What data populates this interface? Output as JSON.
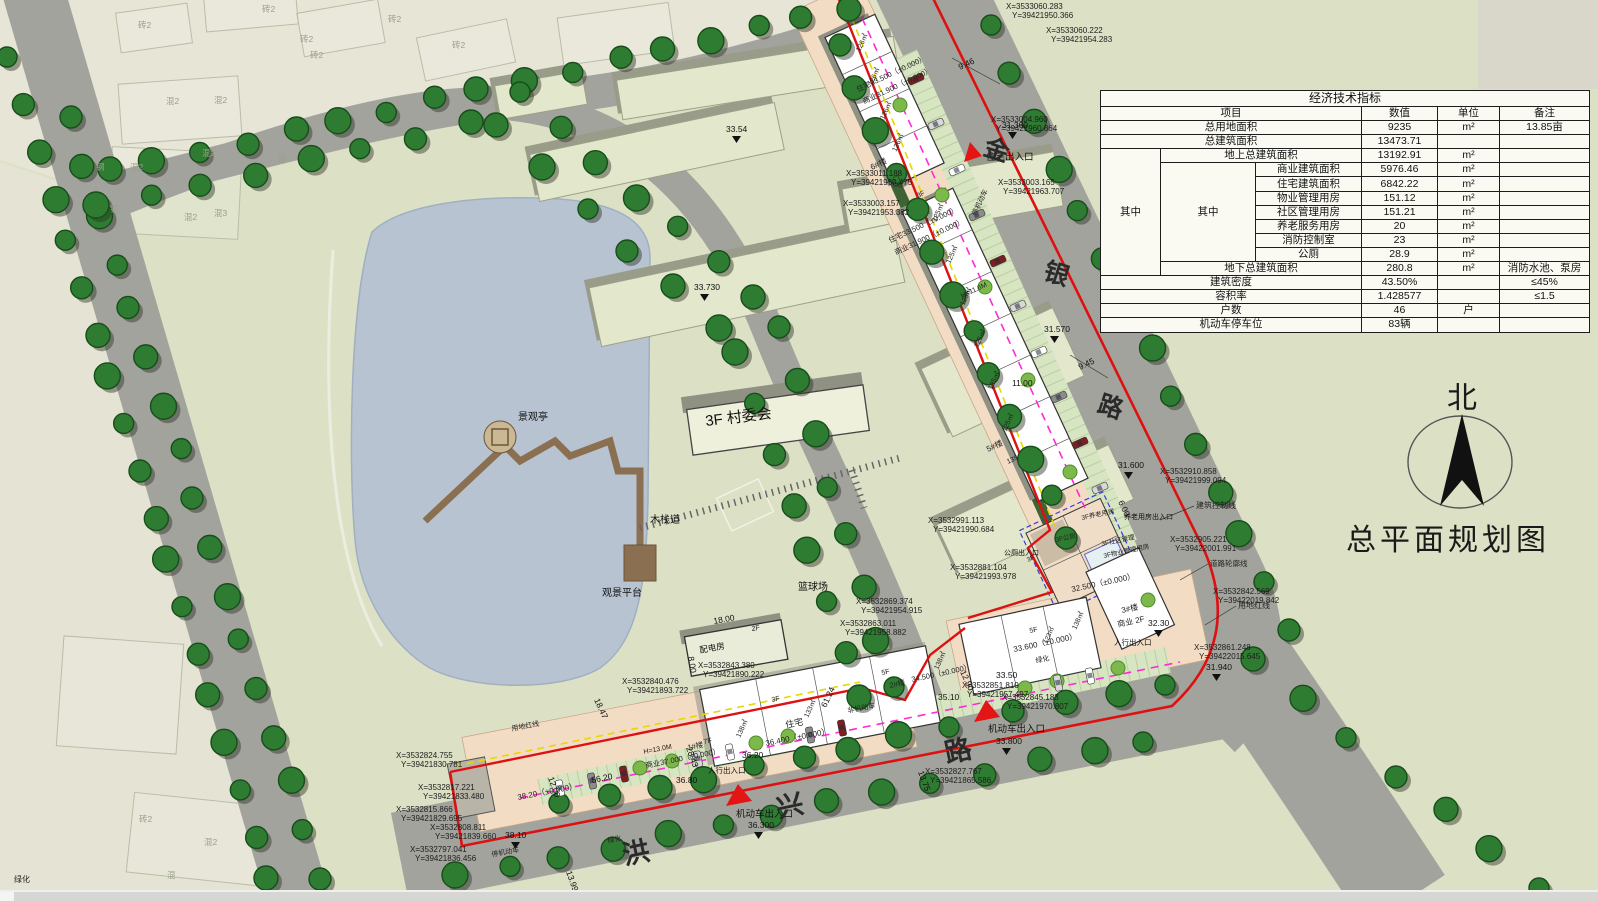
{
  "title": "总平面规划图",
  "north_label": "北",
  "table": {
    "title": "经济技术指标",
    "headers": {
      "item": "项目",
      "value": "数值",
      "unit": "单位",
      "remark": "备注"
    },
    "group_outer": "其中",
    "group_inner": "其中",
    "rows": [
      {
        "item": "总用地面积",
        "value": "9235",
        "unit": "m²",
        "remark": "13.85亩",
        "level": 0
      },
      {
        "item": "总建筑面积",
        "value": "13473.71",
        "unit": "",
        "remark": "",
        "level": 0
      },
      {
        "item": "地上总建筑面积",
        "value": "13192.91",
        "unit": "m²",
        "remark": "",
        "level": 1
      },
      {
        "item": "商业建筑面积",
        "value": "5976.46",
        "unit": "m²",
        "remark": "",
        "level": 2
      },
      {
        "item": "住宅建筑面积",
        "value": "6842.22",
        "unit": "m²",
        "remark": "",
        "level": 2
      },
      {
        "item": "物业管理用房",
        "value": "151.12",
        "unit": "m²",
        "remark": "",
        "level": 2
      },
      {
        "item": "社区管理用房",
        "value": "151.21",
        "unit": "m²",
        "remark": "",
        "level": 2
      },
      {
        "item": "养老服务用房",
        "value": "20",
        "unit": "m²",
        "remark": "",
        "level": 2
      },
      {
        "item": "消防控制室",
        "value": "23",
        "unit": "m²",
        "remark": "",
        "level": 2
      },
      {
        "item": "公厕",
        "value": "28.9",
        "unit": "m²",
        "remark": "",
        "level": 2
      },
      {
        "item": "地下总建筑面积",
        "value": "280.8",
        "unit": "m²",
        "remark": "消防水池、泵房",
        "level": 1
      },
      {
        "item": "建筑密度",
        "value": "43.50%",
        "unit": "",
        "remark": "≤45%",
        "level": 0
      },
      {
        "item": "容积率",
        "value": "1.428577",
        "unit": "",
        "remark": "≤1.5",
        "level": 0
      },
      {
        "item": "户数",
        "value": "46",
        "unit": "户",
        "remark": "",
        "level": 0
      },
      {
        "item": "机动车停车位",
        "value": "83辆",
        "unit": "",
        "remark": "",
        "level": 0
      }
    ]
  },
  "map": {
    "road_names": [
      {
        "t": "金",
        "x": 994,
        "y": 158,
        "r": 18,
        "s": 25
      },
      {
        "t": "银",
        "x": 1054,
        "y": 282,
        "r": 18,
        "s": 25
      },
      {
        "t": "路",
        "x": 1108,
        "y": 415,
        "r": 18,
        "s": 25
      },
      {
        "t": "洪",
        "x": 638,
        "y": 862,
        "r": -12,
        "s": 27
      },
      {
        "t": "兴",
        "x": 792,
        "y": 815,
        "r": -12,
        "s": 27
      },
      {
        "t": "路",
        "x": 960,
        "y": 760,
        "r": -12,
        "s": 27
      }
    ],
    "places": [
      {
        "t": "景观亭",
        "x": 518,
        "y": 420,
        "s": 10
      },
      {
        "t": "木栈道",
        "x": 650,
        "y": 523,
        "s": 10
      },
      {
        "t": "观景平台",
        "x": 602,
        "y": 596,
        "s": 10
      },
      {
        "t": "3F 村委会",
        "x": 706,
        "y": 426,
        "r": -7,
        "s": 15
      },
      {
        "t": "篮球场",
        "x": 798,
        "y": 590,
        "s": 10
      },
      {
        "t": "配电房",
        "x": 700,
        "y": 653,
        "r": -10,
        "s": 8.5
      },
      {
        "t": "2F",
        "x": 752,
        "y": 631,
        "r": -10,
        "s": 7
      }
    ],
    "buildings": [
      {
        "t": "住宅33.500（±0.000）",
        "x": 858,
        "y": 92,
        "r": -25,
        "s": 7.5
      },
      {
        "t": "商业31.900（±0.000）",
        "x": 864,
        "y": 104,
        "r": -25,
        "s": 7.5
      },
      {
        "t": "126㎡",
        "x": 860,
        "y": 52,
        "r": -65,
        "s": 7
      },
      {
        "t": "126㎡",
        "x": 872,
        "y": 86,
        "r": -65,
        "s": 7
      },
      {
        "t": "126㎡",
        "x": 884,
        "y": 120,
        "r": -65,
        "s": 7
      },
      {
        "t": "126㎡",
        "x": 896,
        "y": 152,
        "r": -65,
        "s": 7
      },
      {
        "t": "6#楼",
        "x": 872,
        "y": 170,
        "r": -25,
        "s": 8
      },
      {
        "t": "大门",
        "x": 888,
        "y": 186,
        "r": -25,
        "s": 7
      },
      {
        "t": "3F",
        "x": 918,
        "y": 198,
        "r": -25,
        "s": 7
      },
      {
        "t": "住宅33.500（±0.000）",
        "x": 890,
        "y": 243,
        "r": -25,
        "s": 7.5
      },
      {
        "t": "商业31.900（±0.000）",
        "x": 896,
        "y": 255,
        "r": -25,
        "s": 7.5
      },
      {
        "t": "H=11.6M",
        "x": 962,
        "y": 298,
        "r": -25,
        "s": 7
      },
      {
        "t": "125㎡",
        "x": 936,
        "y": 222,
        "r": -65,
        "s": 7
      },
      {
        "t": "125㎡",
        "x": 950,
        "y": 264,
        "r": -65,
        "s": 7
      },
      {
        "t": "125㎡",
        "x": 964,
        "y": 306,
        "r": -65,
        "s": 7
      },
      {
        "t": "125㎡",
        "x": 978,
        "y": 348,
        "r": -65,
        "s": 7
      },
      {
        "t": "125㎡",
        "x": 992,
        "y": 390,
        "r": -65,
        "s": 7
      },
      {
        "t": "125㎡",
        "x": 1006,
        "y": 432,
        "r": -65,
        "s": 7
      },
      {
        "t": "5#楼",
        "x": 988,
        "y": 452,
        "r": -25,
        "s": 8
      },
      {
        "t": "135",
        "x": 1008,
        "y": 464,
        "r": -25,
        "s": 7
      },
      {
        "t": "3F",
        "x": 1028,
        "y": 562,
        "r": -25,
        "s": 6.5
      },
      {
        "t": "3F养老用房",
        "x": 1082,
        "y": 520,
        "r": -12,
        "s": 6.5
      },
      {
        "t": "3F公厕",
        "x": 1056,
        "y": 542,
        "r": -12,
        "s": 6.5
      },
      {
        "t": "3F社区管理",
        "x": 1102,
        "y": 546,
        "r": -12,
        "s": 6.5
      },
      {
        "t": "3F物业管理用房",
        "x": 1104,
        "y": 558,
        "r": -12,
        "s": 6.5
      },
      {
        "t": "32.500（±0.000）",
        "x": 1072,
        "y": 592,
        "r": -12,
        "s": 8
      },
      {
        "t": "3#楼",
        "x": 1122,
        "y": 613,
        "r": -12,
        "s": 8
      },
      {
        "t": "商业 2F",
        "x": 1118,
        "y": 627,
        "r": -12,
        "s": 8
      },
      {
        "t": "138㎡",
        "x": 1076,
        "y": 630,
        "r": -65,
        "s": 7
      },
      {
        "t": "5F",
        "x": 1030,
        "y": 633,
        "r": -12,
        "s": 7
      },
      {
        "t": "123㎡",
        "x": 1047,
        "y": 644,
        "r": -65,
        "s": 6.5
      },
      {
        "t": "33.600（±0.000）",
        "x": 1014,
        "y": 652,
        "r": -12,
        "s": 8
      },
      {
        "t": "5F",
        "x": 882,
        "y": 675,
        "r": -12,
        "s": 7
      },
      {
        "t": "2#楼",
        "x": 890,
        "y": 688,
        "r": -12,
        "s": 7.5
      },
      {
        "t": "138㎡",
        "x": 938,
        "y": 670,
        "r": -65,
        "s": 7
      },
      {
        "t": "34.500（±0.000）",
        "x": 912,
        "y": 682,
        "r": -12,
        "s": 7.5
      },
      {
        "t": "住宅",
        "x": 786,
        "y": 728,
        "r": -11,
        "s": 9
      },
      {
        "t": "133㎡",
        "x": 808,
        "y": 718,
        "r": -65,
        "s": 7
      },
      {
        "t": "138㎡",
        "x": 740,
        "y": 738,
        "r": -65,
        "s": 7
      },
      {
        "t": "36.400（±0.000）",
        "x": 766,
        "y": 746,
        "r": -11,
        "s": 8
      },
      {
        "t": "7F",
        "x": 704,
        "y": 744,
        "r": -11,
        "s": 7
      },
      {
        "t": "3F",
        "x": 772,
        "y": 702,
        "r": -11,
        "s": 7
      },
      {
        "t": "H=13.0M",
        "x": 644,
        "y": 754,
        "r": -11,
        "s": 7
      },
      {
        "t": "1#楼",
        "x": 688,
        "y": 750,
        "r": -11,
        "s": 7.5
      },
      {
        "t": "商业37.000（±0.000）",
        "x": 646,
        "y": 768,
        "r": -11,
        "s": 7.5
      },
      {
        "t": "38.20（±0.000）",
        "x": 518,
        "y": 800,
        "r": -11,
        "s": 8
      }
    ],
    "levels": [
      {
        "t": "31.360",
        "x": 1002,
        "y": 128,
        "m": 1
      },
      {
        "t": "9.46",
        "x": 960,
        "y": 70,
        "r": -25
      },
      {
        "t": "9.45",
        "x": 1080,
        "y": 370,
        "r": -25
      },
      {
        "t": "31.570",
        "x": 1044,
        "y": 332,
        "m": 1
      },
      {
        "t": "31.600",
        "x": 1118,
        "y": 468,
        "m": 1
      },
      {
        "t": "6.00",
        "x": 1118,
        "y": 502,
        "r": 65
      },
      {
        "t": "32.30",
        "x": 1148,
        "y": 626,
        "m": 1
      },
      {
        "t": "31.940",
        "x": 1206,
        "y": 670,
        "m": 1
      },
      {
        "t": "33.50",
        "x": 996,
        "y": 678
      },
      {
        "t": "33.800",
        "x": 996,
        "y": 744,
        "m": 1
      },
      {
        "t": "35.10",
        "x": 938,
        "y": 700
      },
      {
        "t": "12.90",
        "x": 960,
        "y": 672,
        "r": 65
      },
      {
        "t": "33.54",
        "x": 726,
        "y": 132,
        "m": 1
      },
      {
        "t": "33.730",
        "x": 694,
        "y": 290,
        "m": 1
      },
      {
        "t": "36.300",
        "x": 748,
        "y": 828,
        "m": 1
      },
      {
        "t": "36.20",
        "x": 742,
        "y": 758
      },
      {
        "t": "36.80",
        "x": 676,
        "y": 783
      },
      {
        "t": "38.10",
        "x": 505,
        "y": 838,
        "m": 1
      },
      {
        "t": "13.99",
        "x": 566,
        "y": 872,
        "r": 70
      },
      {
        "t": "13.75",
        "x": 918,
        "y": 772,
        "r": 70
      },
      {
        "t": "11.00",
        "x": 1012,
        "y": 386
      },
      {
        "t": "18.00",
        "x": 714,
        "y": 624,
        "r": -10
      },
      {
        "t": "8.00",
        "x": 688,
        "y": 657,
        "r": 80
      },
      {
        "t": "18.47",
        "x": 594,
        "y": 700,
        "r": 65
      },
      {
        "t": "56.20",
        "x": 592,
        "y": 783,
        "r": -11
      },
      {
        "t": "12.00",
        "x": 548,
        "y": 778,
        "r": 70
      },
      {
        "t": "28.43",
        "x": 686,
        "y": 748,
        "r": 70
      },
      {
        "t": "61.24",
        "x": 826,
        "y": 708,
        "r": -65
      }
    ],
    "coords": [
      {
        "t": "X=3533060.283",
        "x": 1006,
        "y": 9
      },
      {
        "t": "Y=39421950.366",
        "x": 1012,
        "y": 18
      },
      {
        "t": "X=3533060.222",
        "x": 1046,
        "y": 33
      },
      {
        "t": "Y=39421954.283",
        "x": 1051,
        "y": 42
      },
      {
        "t": "X=3533004.960",
        "x": 991,
        "y": 122
      },
      {
        "t": "Y=39421960.864",
        "x": 996,
        "y": 131
      },
      {
        "t": "X=3533003.165",
        "x": 998,
        "y": 185
      },
      {
        "t": "Y=39421963.707",
        "x": 1003,
        "y": 194
      },
      {
        "t": "X=3533011.188",
        "x": 846,
        "y": 176
      },
      {
        "t": "Y=39421950.475",
        "x": 851,
        "y": 185
      },
      {
        "t": "X=3533003.157",
        "x": 843,
        "y": 206
      },
      {
        "t": "Y=39421953.382",
        "x": 848,
        "y": 215
      },
      {
        "t": "X=3532910.858",
        "x": 1160,
        "y": 474
      },
      {
        "t": "Y=39421999.094",
        "x": 1165,
        "y": 483
      },
      {
        "t": "X=3532905.221",
        "x": 1170,
        "y": 542
      },
      {
        "t": "Y=39422001.991",
        "x": 1175,
        "y": 551
      },
      {
        "t": "X=3532991.113",
        "x": 928,
        "y": 523
      },
      {
        "t": "Y=39421990.684",
        "x": 933,
        "y": 532
      },
      {
        "t": "X=3532881.104",
        "x": 950,
        "y": 570
      },
      {
        "t": "Y=39421993.978",
        "x": 955,
        "y": 579
      },
      {
        "t": "X=3532842.569",
        "x": 1213,
        "y": 594
      },
      {
        "t": "Y=39422019.842",
        "x": 1218,
        "y": 603
      },
      {
        "t": "X=3532861.248",
        "x": 1194,
        "y": 650
      },
      {
        "t": "Y=39422015.645",
        "x": 1199,
        "y": 659
      },
      {
        "t": "X=3532869.374",
        "x": 856,
        "y": 604
      },
      {
        "t": "Y=39421954.915",
        "x": 861,
        "y": 613
      },
      {
        "t": "X=3532863.011",
        "x": 840,
        "y": 626
      },
      {
        "t": "Y=39421958.882",
        "x": 845,
        "y": 635
      },
      {
        "t": "X=3532843.380",
        "x": 698,
        "y": 668
      },
      {
        "t": "Y=39421890.222",
        "x": 703,
        "y": 677
      },
      {
        "t": "X=3532840.476",
        "x": 622,
        "y": 684
      },
      {
        "t": "Y=39421893.722",
        "x": 627,
        "y": 693
      },
      {
        "t": "X=3532851.810",
        "x": 962,
        "y": 688
      },
      {
        "t": "Y=39421957.497",
        "x": 967,
        "y": 697
      },
      {
        "t": "X=3532845.183",
        "x": 1002,
        "y": 700
      },
      {
        "t": "Y=39421970.807",
        "x": 1007,
        "y": 709
      },
      {
        "t": "X=3532827.767",
        "x": 925,
        "y": 774
      },
      {
        "t": "Y=39421865.586",
        "x": 930,
        "y": 783
      },
      {
        "t": "X=3532824.755",
        "x": 396,
        "y": 758
      },
      {
        "t": "Y=39421830.781",
        "x": 401,
        "y": 767
      },
      {
        "t": "X=3532817.221",
        "x": 418,
        "y": 790
      },
      {
        "t": "Y=39421833.480",
        "x": 423,
        "y": 799
      },
      {
        "t": "X=3532815.866",
        "x": 396,
        "y": 812
      },
      {
        "t": "Y=39421829.695",
        "x": 401,
        "y": 821
      },
      {
        "t": "X=3532808.811",
        "x": 430,
        "y": 830
      },
      {
        "t": "Y=39421839.660",
        "x": 435,
        "y": 839
      },
      {
        "t": "X=3532797.041",
        "x": 410,
        "y": 852
      },
      {
        "t": "Y=39421836.456",
        "x": 415,
        "y": 861
      }
    ],
    "context": [
      {
        "t": "砖2",
        "x": 138,
        "y": 28
      },
      {
        "t": "砖2",
        "x": 262,
        "y": 12
      },
      {
        "t": "砖2",
        "x": 300,
        "y": 42
      },
      {
        "t": "砖2",
        "x": 388,
        "y": 22
      },
      {
        "t": "砖2",
        "x": 452,
        "y": 48
      },
      {
        "t": "砖2",
        "x": 310,
        "y": 58
      },
      {
        "t": "混2",
        "x": 166,
        "y": 104
      },
      {
        "t": "混2",
        "x": 214,
        "y": 103
      },
      {
        "t": "混2",
        "x": 130,
        "y": 170
      },
      {
        "t": "混2",
        "x": 202,
        "y": 156
      },
      {
        "t": "混2",
        "x": 184,
        "y": 220
      },
      {
        "t": "混3",
        "x": 214,
        "y": 216
      },
      {
        "t": "钢",
        "x": 96,
        "y": 170
      },
      {
        "t": "钢",
        "x": 110,
        "y": 212
      },
      {
        "t": "建",
        "x": 278,
        "y": 162
      },
      {
        "t": "混2",
        "x": 204,
        "y": 845
      },
      {
        "t": "混",
        "x": 167,
        "y": 878
      },
      {
        "t": "砖2",
        "x": 139,
        "y": 822
      }
    ],
    "line_labels": [
      {
        "t": "建筑控制线",
        "x": 1196,
        "y": 508,
        "s": 8
      },
      {
        "t": "道路轮廓线",
        "x": 1210,
        "y": 566,
        "s": 7.5
      },
      {
        "t": "用地红线",
        "x": 1238,
        "y": 608,
        "s": 8
      },
      {
        "t": "用地红线",
        "x": 512,
        "y": 731,
        "r": -11,
        "s": 7
      },
      {
        "t": "绿化",
        "x": 14,
        "y": 882,
        "s": 8
      },
      {
        "t": "绿化",
        "x": 608,
        "y": 843,
        "r": -11,
        "s": 7
      },
      {
        "t": "绿化",
        "x": 1036,
        "y": 663,
        "r": -11,
        "s": 7
      },
      {
        "t": "停机动车",
        "x": 976,
        "y": 216,
        "r": -65,
        "s": 7
      },
      {
        "t": "非机动车",
        "x": 848,
        "y": 713,
        "r": -11,
        "s": 7
      },
      {
        "t": "停机动车",
        "x": 492,
        "y": 857,
        "r": -11,
        "s": 7
      }
    ],
    "entrances": [
      {
        "t": "住宅出入口",
        "x": 986,
        "y": 160,
        "s": 9.5
      },
      {
        "t": "机动车出入口",
        "x": 988,
        "y": 732,
        "s": 9.5
      },
      {
        "t": "机动车出入口",
        "x": 736,
        "y": 817,
        "s": 9.5
      },
      {
        "t": "人行出入口",
        "x": 708,
        "y": 773,
        "s": 7.5
      },
      {
        "t": "人行出入口",
        "x": 1114,
        "y": 645,
        "s": 7.5
      },
      {
        "t": "养老用房出入口",
        "x": 1124,
        "y": 519,
        "s": 7
      },
      {
        "t": "公厕出入口",
        "x": 1004,
        "y": 555,
        "s": 7
      }
    ]
  }
}
